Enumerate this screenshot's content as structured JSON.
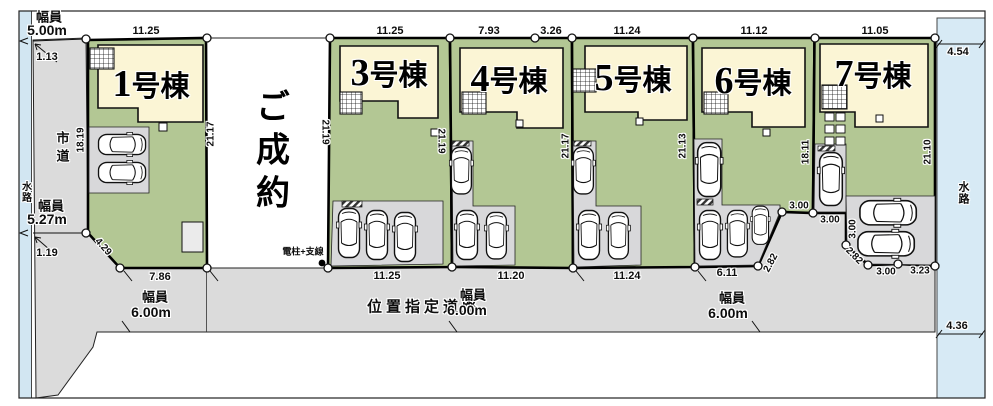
{
  "lots": [
    {
      "num": "1",
      "suffix": "号棟",
      "dim_top": "11.25",
      "dim_left": "18.19",
      "dim_right": "21.17"
    },
    {
      "status": "ご成約",
      "dim_right": "21.19"
    },
    {
      "num": "3",
      "suffix": "号棟",
      "dim_top": "11.25",
      "dim_bottom": "11.25",
      "dim_right": "21.19"
    },
    {
      "num": "4",
      "suffix": "号棟",
      "dim_top_left": "7.93",
      "dim_top_right": "3.26",
      "dim_bottom": "11.20",
      "dim_right": "21.17"
    },
    {
      "num": "5",
      "suffix": "号棟",
      "dim_top": "11.24",
      "dim_bottom": "11.24",
      "dim_right": "21.13"
    },
    {
      "num": "6",
      "suffix": "号棟",
      "dim_top": "11.12",
      "dim_bottom": "6.11",
      "dim_diag": "2.82",
      "dim_notch": "3.00",
      "dim_right": "18.11"
    },
    {
      "num": "7",
      "suffix": "号棟",
      "dim_top": "11.05",
      "dim_entry_top": "3.00",
      "dim_entry_side": "3.00",
      "dim_diag": "2.82",
      "dim_bottom_left": "3.00",
      "dim_bottom_right": "3.23",
      "dim_right": "21.10"
    }
  ],
  "roads": {
    "city_road_label": "市道",
    "width_label": "幅員",
    "width_north": "5.00m",
    "setback_north": "1.13",
    "width_mid": "5.27m",
    "setback_south": "1.19",
    "corner_cut": "4.29",
    "frontage_west": "7.86",
    "designated_label": "位置指定道路",
    "width_south": "6.00m"
  },
  "waterway": {
    "label": "水路",
    "north_width": "4.54",
    "south_width": "4.36"
  },
  "pole_label": "電柱+支線"
}
